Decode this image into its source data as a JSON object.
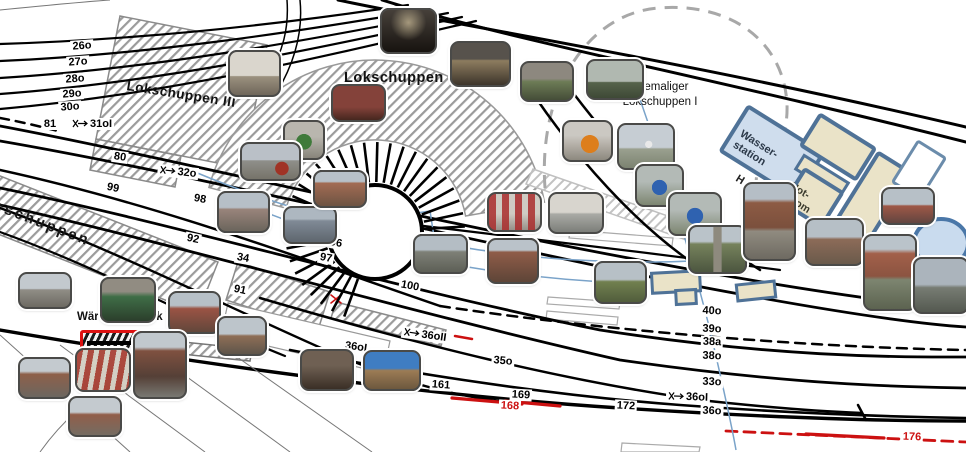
{
  "labels": {
    "lokschuppen3": "Lokschuppen III",
    "lokschuppen2": "Lokschuppen II",
    "lokschuppen1_l1": "ehemaliger",
    "lokschuppen1_l2": "Lokschuppen I",
    "gueterschuppen_partial": "erschuppen",
    "wasser_l1": "Wasser-",
    "wasser_l2": "station",
    "notstrom_l1": "Not-",
    "notstrom_l2": "strom",
    "waerterstellwerk": "Wärterstellwerk Wm",
    "partial_h": "H"
  },
  "track_labels": [
    {
      "t": "26o",
      "x": 82,
      "y": 46,
      "r": -4
    },
    {
      "t": "27o",
      "x": 78,
      "y": 62,
      "r": -4
    },
    {
      "t": "28o",
      "x": 75,
      "y": 79,
      "r": -4
    },
    {
      "t": "29o",
      "x": 72,
      "y": 94,
      "r": -4
    },
    {
      "t": "30o",
      "x": 70,
      "y": 107,
      "r": -4
    },
    {
      "t": "81",
      "x": 50,
      "y": 124,
      "r": 0
    },
    {
      "t": "31oI",
      "x": 92,
      "y": 124,
      "r": 0,
      "sw": true
    },
    {
      "t": "80",
      "x": 120,
      "y": 157,
      "r": 8
    },
    {
      "t": "32o",
      "x": 178,
      "y": 172,
      "r": 6,
      "sw": true
    },
    {
      "t": "99",
      "x": 113,
      "y": 188,
      "r": 12
    },
    {
      "t": "98",
      "x": 200,
      "y": 199,
      "r": 10
    },
    {
      "t": "92",
      "x": 193,
      "y": 239,
      "r": 12
    },
    {
      "t": "34",
      "x": 243,
      "y": 258,
      "r": 10
    },
    {
      "t": "91",
      "x": 240,
      "y": 290,
      "r": 12
    },
    {
      "t": "96",
      "x": 336,
      "y": 243,
      "r": 10
    },
    {
      "t": "97",
      "x": 326,
      "y": 258,
      "r": 10
    },
    {
      "t": "100",
      "x": 410,
      "y": 286,
      "r": 10
    },
    {
      "t": "36oII",
      "x": 425,
      "y": 335,
      "r": 8,
      "sw": true
    },
    {
      "t": "36oI",
      "x": 356,
      "y": 347,
      "r": 8
    },
    {
      "t": "35o",
      "x": 503,
      "y": 361,
      "r": 5
    },
    {
      "t": "161",
      "x": 441,
      "y": 385,
      "r": 4
    },
    {
      "t": "169",
      "x": 521,
      "y": 395,
      "r": 3
    },
    {
      "t": "168",
      "x": 510,
      "y": 406,
      "r": 3,
      "red": true
    },
    {
      "t": "172",
      "x": 626,
      "y": 406,
      "r": 3
    },
    {
      "t": "36oI",
      "x": 688,
      "y": 397,
      "r": 2,
      "sw": true
    },
    {
      "t": "33o",
      "x": 712,
      "y": 382,
      "r": 2
    },
    {
      "t": "36o",
      "x": 712,
      "y": 411,
      "r": 2
    },
    {
      "t": "38o",
      "x": 712,
      "y": 356,
      "r": 2
    },
    {
      "t": "38a",
      "x": 712,
      "y": 342,
      "r": 2
    },
    {
      "t": "39o",
      "x": 712,
      "y": 329,
      "r": 2
    },
    {
      "t": "40o",
      "x": 712,
      "y": 311,
      "r": 2
    },
    {
      "t": "176",
      "x": 912,
      "y": 437,
      "r": 2,
      "red": true
    }
  ],
  "photos": [
    {
      "x": 380,
      "y": 8,
      "w": 53,
      "h": 42,
      "k": "interior-dark"
    },
    {
      "x": 228,
      "y": 50,
      "w": 49,
      "h": 43,
      "k": "interior-light"
    },
    {
      "x": 331,
      "y": 84,
      "w": 51,
      "h": 34,
      "k": "interior-red"
    },
    {
      "x": 450,
      "y": 41,
      "w": 57,
      "h": 42,
      "k": "interior-wood"
    },
    {
      "x": 520,
      "y": 61,
      "w": 50,
      "h": 37,
      "k": "interior-green"
    },
    {
      "x": 586,
      "y": 59,
      "w": 54,
      "h": 37,
      "k": "structure-field"
    },
    {
      "x": 562,
      "y": 120,
      "w": 47,
      "h": 38,
      "k": "machine-orange"
    },
    {
      "x": 617,
      "y": 123,
      "w": 54,
      "h": 43,
      "k": "field-tower"
    },
    {
      "x": 283,
      "y": 120,
      "w": 38,
      "h": 36,
      "k": "machine-green"
    },
    {
      "x": 240,
      "y": 142,
      "w": 57,
      "h": 35,
      "k": "street-car"
    },
    {
      "x": 217,
      "y": 191,
      "w": 49,
      "h": 38,
      "k": "house-track"
    },
    {
      "x": 283,
      "y": 206,
      "w": 50,
      "h": 34,
      "k": "canopy-train"
    },
    {
      "x": 313,
      "y": 170,
      "w": 50,
      "h": 34,
      "k": "brick-building"
    },
    {
      "x": 413,
      "y": 234,
      "w": 51,
      "h": 36,
      "k": "tracks-yard"
    },
    {
      "x": 487,
      "y": 192,
      "w": 51,
      "h": 36,
      "k": "interior-lockers"
    },
    {
      "x": 548,
      "y": 192,
      "w": 52,
      "h": 38,
      "k": "interior-office"
    },
    {
      "x": 487,
      "y": 238,
      "w": 48,
      "h": 42,
      "k": "brick-row"
    },
    {
      "x": 594,
      "y": 261,
      "w": 49,
      "h": 39,
      "k": "path-green"
    },
    {
      "x": 635,
      "y": 164,
      "w": 45,
      "h": 39,
      "k": "machine-blue"
    },
    {
      "x": 668,
      "y": 192,
      "w": 50,
      "h": 40,
      "k": "machine-blue"
    },
    {
      "x": 688,
      "y": 225,
      "w": 55,
      "h": 45,
      "k": "tracks-grass"
    },
    {
      "x": 805,
      "y": 218,
      "w": 55,
      "h": 44,
      "k": "brick-yard"
    },
    {
      "x": 743,
      "y": 182,
      "w": 49,
      "h": 75,
      "k": "tall-brick"
    },
    {
      "x": 881,
      "y": 187,
      "w": 50,
      "h": 34,
      "k": "red-shed"
    },
    {
      "x": 863,
      "y": 234,
      "w": 50,
      "h": 73,
      "k": "water-tower"
    },
    {
      "x": 913,
      "y": 257,
      "w": 52,
      "h": 53,
      "k": "gantry"
    },
    {
      "x": 18,
      "y": 272,
      "w": 50,
      "h": 33,
      "k": "street-station"
    },
    {
      "x": 100,
      "y": 277,
      "w": 52,
      "h": 42,
      "k": "interior-cab"
    },
    {
      "x": 168,
      "y": 291,
      "w": 49,
      "h": 39,
      "k": "red-house"
    },
    {
      "x": 217,
      "y": 316,
      "w": 46,
      "h": 36,
      "k": "long-building"
    },
    {
      "x": 18,
      "y": 357,
      "w": 49,
      "h": 38,
      "k": "signal-box"
    },
    {
      "x": 75,
      "y": 348,
      "w": 52,
      "h": 40,
      "k": "lever-frame"
    },
    {
      "x": 133,
      "y": 331,
      "w": 50,
      "h": 64,
      "k": "signal-box-tall"
    },
    {
      "x": 68,
      "y": 396,
      "w": 50,
      "h": 37,
      "k": "station-building"
    },
    {
      "x": 300,
      "y": 349,
      "w": 50,
      "h": 38,
      "k": "dark-car"
    },
    {
      "x": 363,
      "y": 350,
      "w": 54,
      "h": 37,
      "k": "panorama-train"
    }
  ],
  "colors": {
    "track_black": "#000000",
    "red": "#cc1111",
    "hatch_gray": "#9b9b9b",
    "dash_gray": "#a8a8a8",
    "blue_outline": "#4f7297",
    "wasser_fill": "#cfdded",
    "beige_fill": "#eae3c8",
    "pond_fill": "#c9dbee",
    "pipe_blue": "#7aa3c9"
  }
}
